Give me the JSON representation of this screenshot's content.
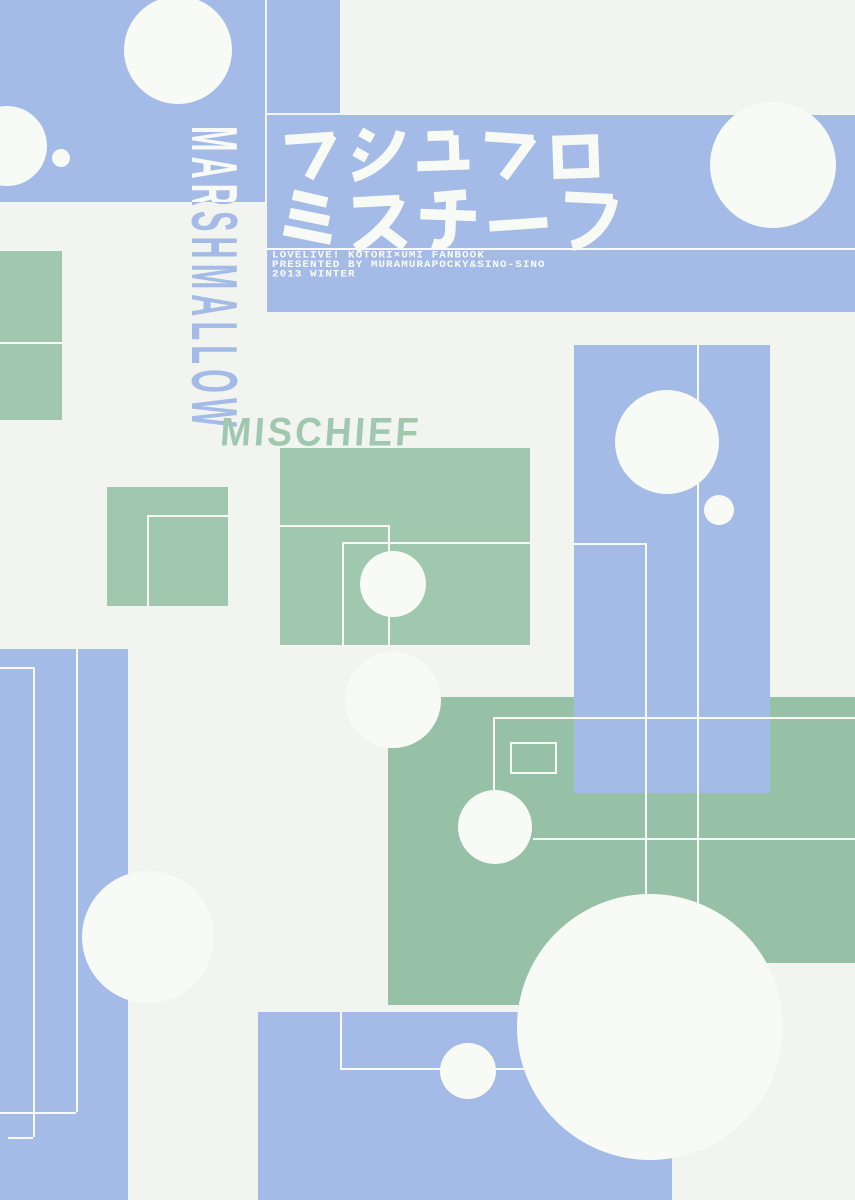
{
  "artwork": {
    "title_line1": "マシユマロ",
    "title_line2": "ミスチーフ",
    "title_full": "マシユマロミスチーフ",
    "romaji_vertical": "MARSHMALLOW",
    "romaji_slanted": "MISCHIEF",
    "credits": {
      "line1": "LOVELIVE! KOTORI×UMI FANBOOK",
      "line2": "PRESENTED BY MURAMURAPOCKY&SINO-SINO",
      "line3": "2013 WINTER"
    }
  },
  "colors": {
    "blue": "#a4bbe7",
    "green": "#9fc8af",
    "green_dark": "#97c1a6",
    "paper_white": "#f2f4ef",
    "shape_white": "#f8faf5"
  }
}
